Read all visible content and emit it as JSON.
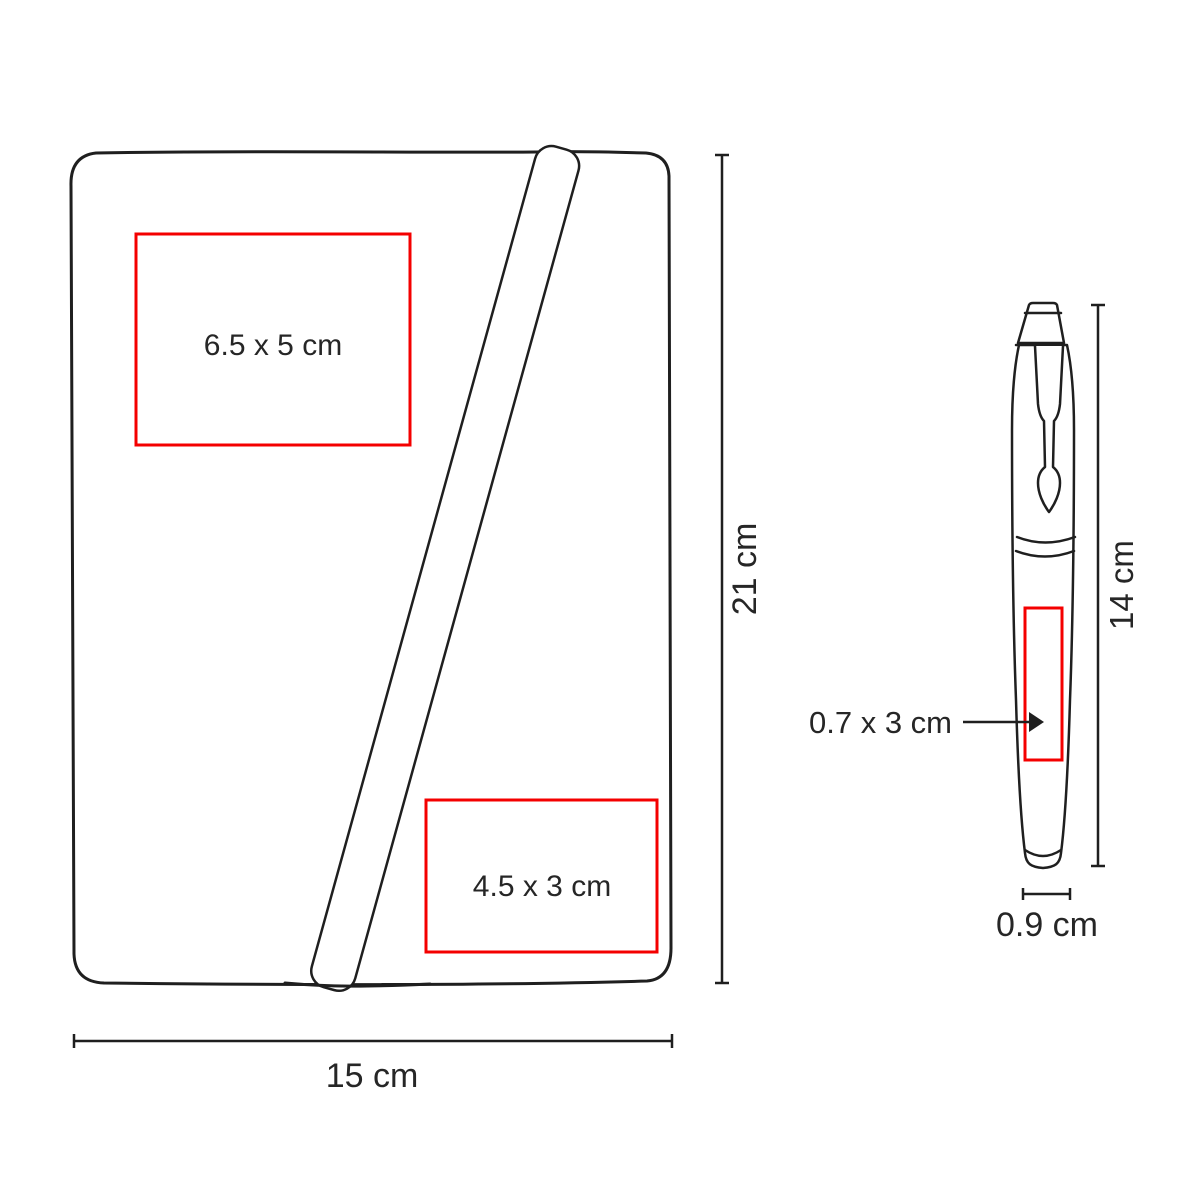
{
  "colors": {
    "outline": "#1f1f1f",
    "imprint_red": "#f40000",
    "text": "#262626",
    "background": "#ffffff"
  },
  "notebook": {
    "imprint_top_label": "6.5 x 5 cm",
    "imprint_bottom_label": "4.5 x 3 cm",
    "height_dim": "21 cm",
    "width_dim": "15 cm"
  },
  "pen": {
    "imprint_label": "0.7 x 3 cm",
    "height_dim": "14 cm",
    "width_dim": "0.9 cm"
  }
}
